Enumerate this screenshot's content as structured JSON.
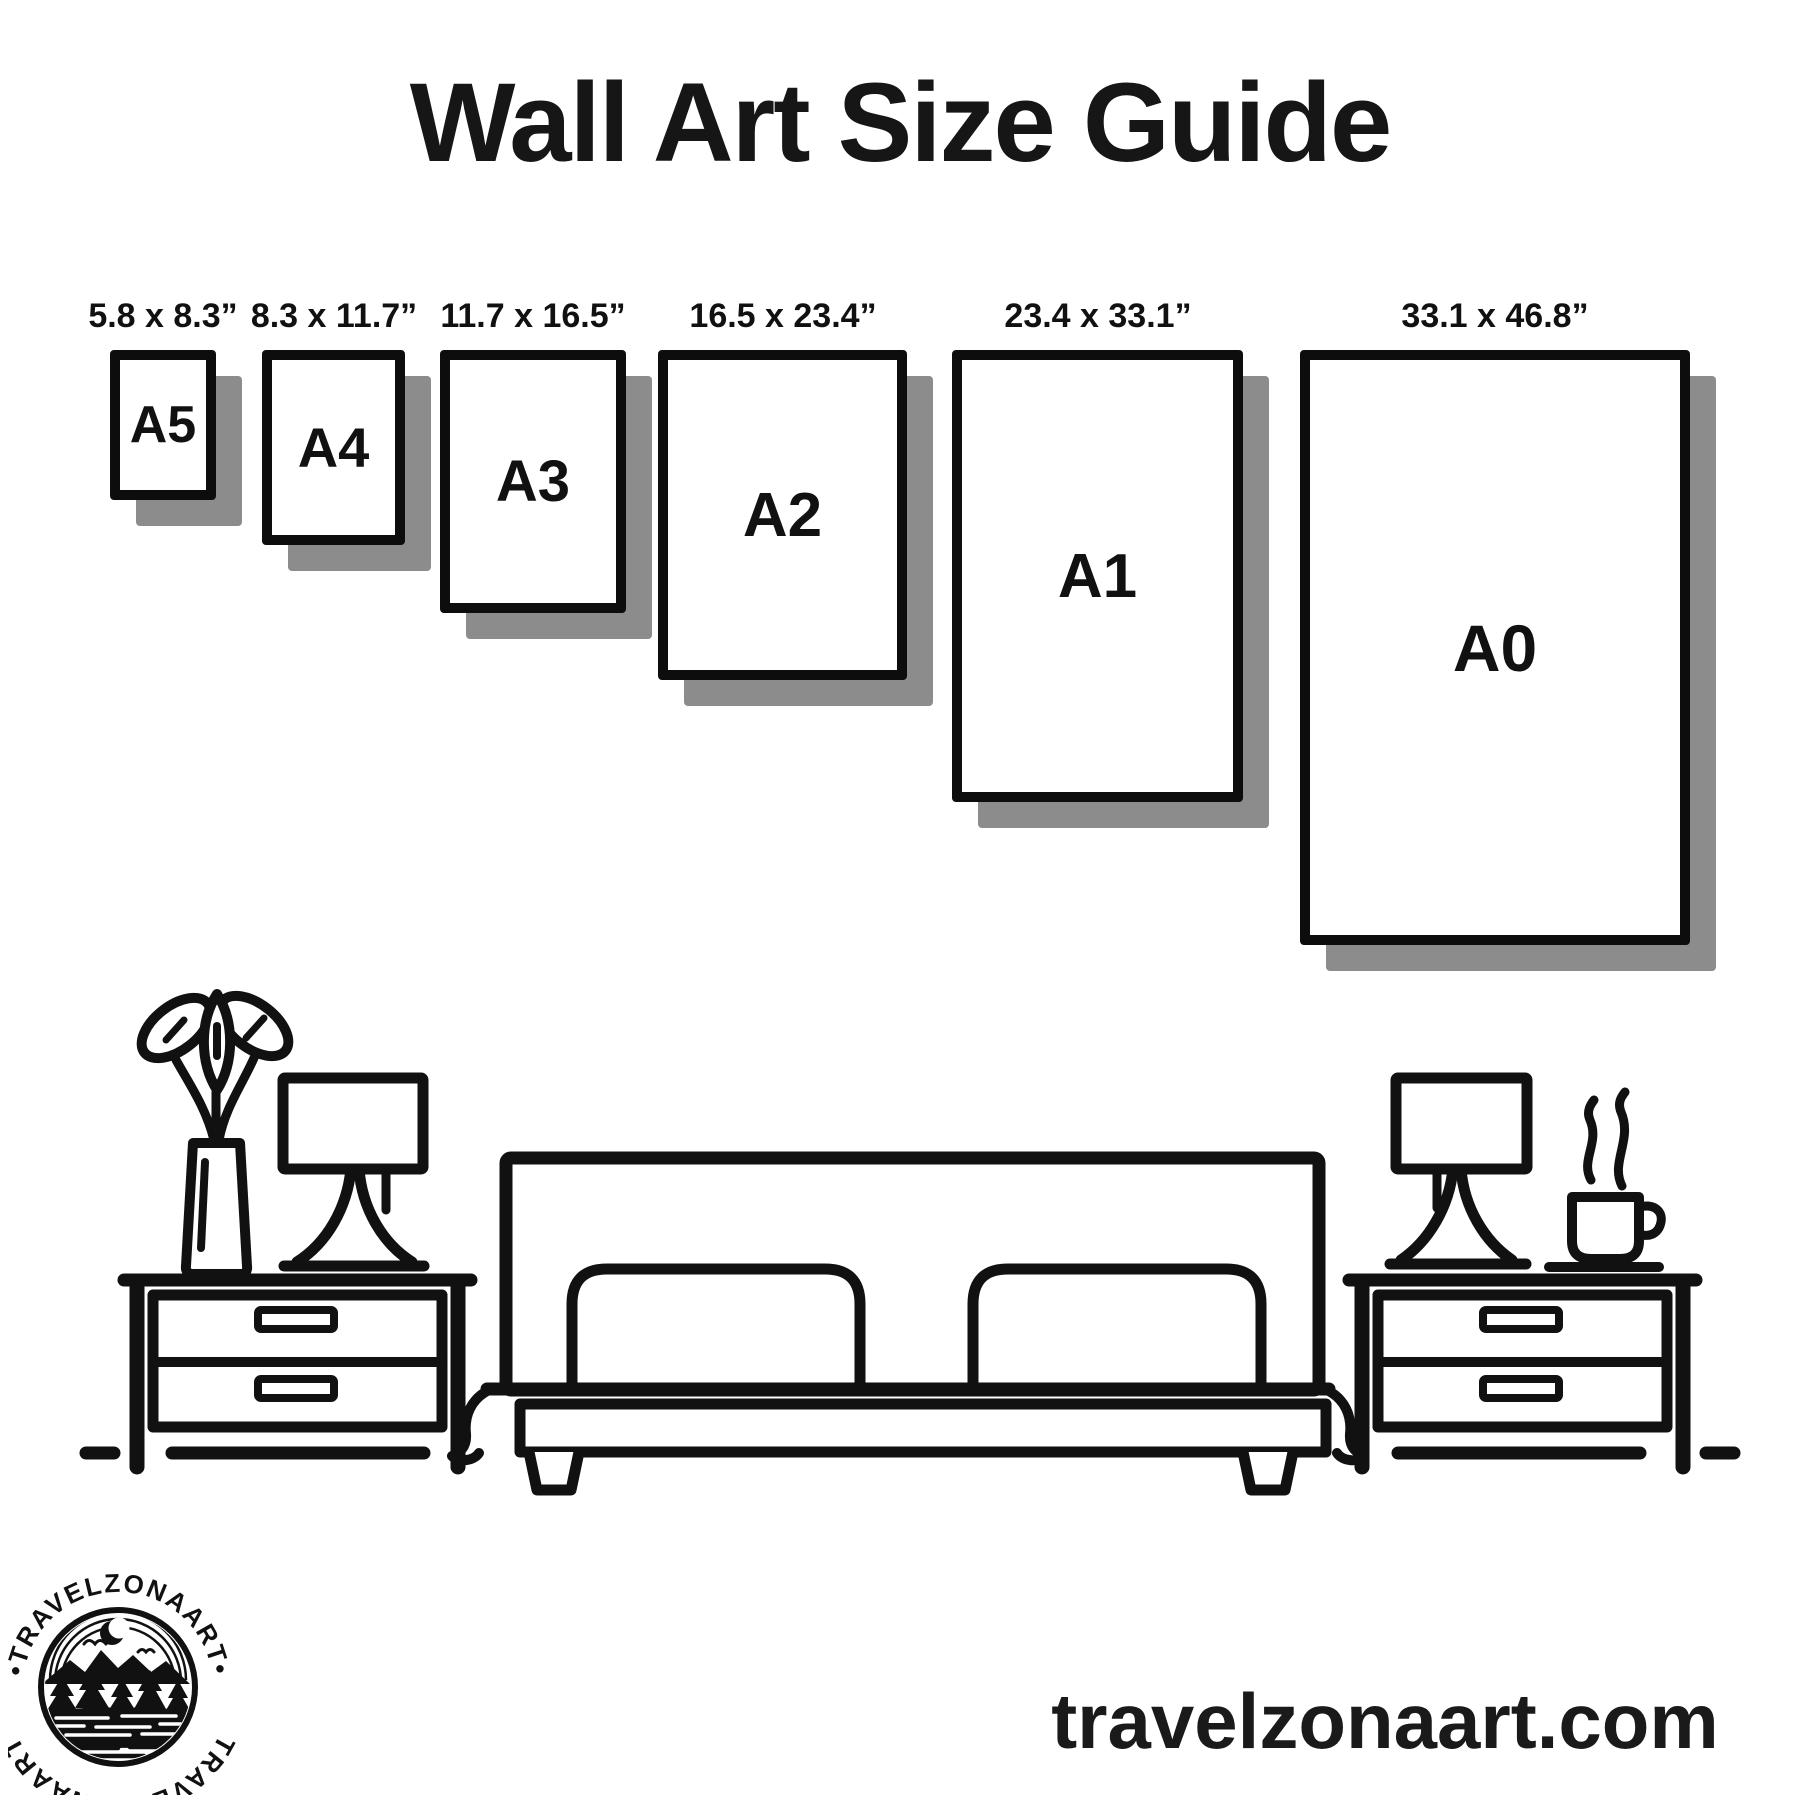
{
  "title": "Wall Art Size Guide",
  "colors": {
    "ink": "#111111",
    "shadow": "#8c8c8c",
    "background": "#ffffff"
  },
  "frames": [
    {
      "label": "A5",
      "dims": "5.8 x 8.3”"
    },
    {
      "label": "A4",
      "dims": "8.3 x 11.7”"
    },
    {
      "label": "A3",
      "dims": "11.7 x 16.5”"
    },
    {
      "label": "A2",
      "dims": "16.5 x 23.4”"
    },
    {
      "label": "A1",
      "dims": "23.4 x 33.1”"
    },
    {
      "label": "A0",
      "dims": "33.1 x 46.8”"
    }
  ],
  "scene": {
    "icons": [
      "potted-plant-icon",
      "table-lamp-icon",
      "nightstand-icon",
      "double-bed-icon",
      "coffee-cup-icon",
      "floor-line-icon"
    ]
  },
  "logo": {
    "badge_text_top": "•TRAVELZONAART•",
    "badge_text_bottom": "TRAVELZONAART",
    "icons": [
      "crescent-moon-icon",
      "mountains-icon",
      "pine-trees-icon",
      "lake-icon",
      "birds-icon"
    ]
  },
  "website": "travelzonaart.com"
}
